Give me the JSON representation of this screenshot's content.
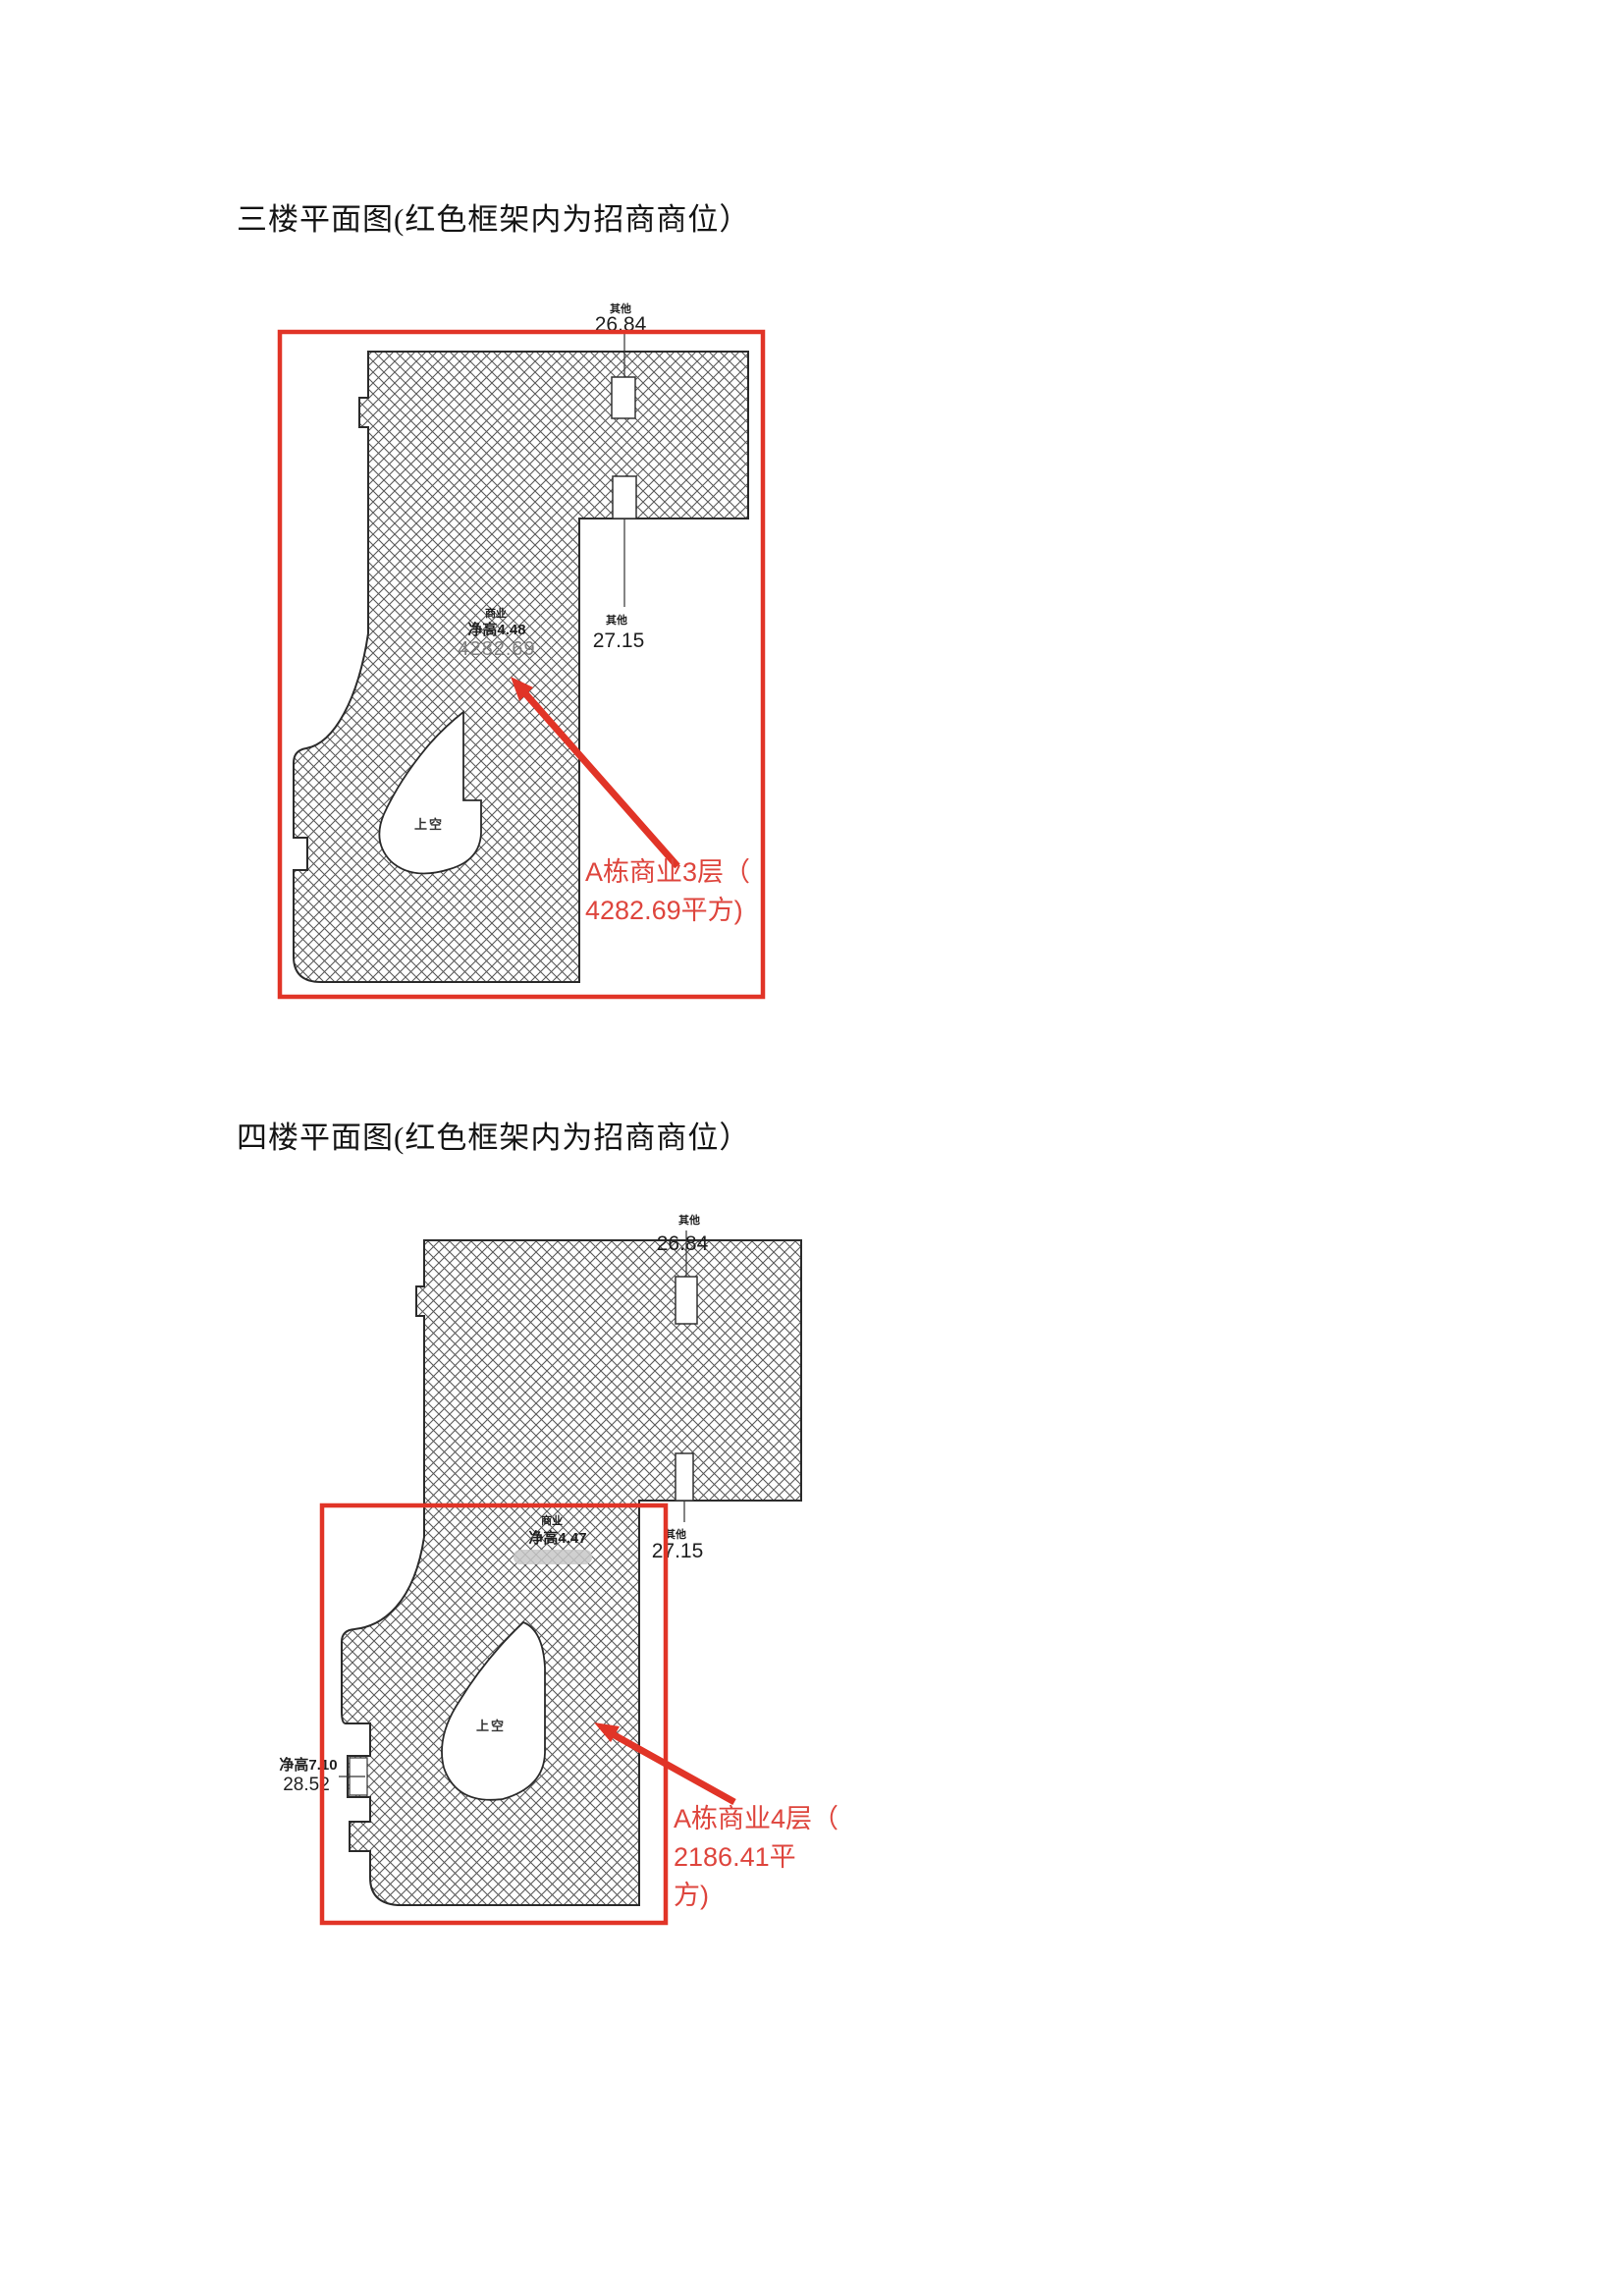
{
  "colors": {
    "frame_red": "#e13427",
    "callout_red": "#de453d",
    "outline": "#2b2b2b",
    "hatch_line": "#5a5a5a",
    "blur_pill": "#c8c8c8"
  },
  "floors": [
    {
      "title": "三楼平面图(红色框架内为招商商位）",
      "dims": {
        "top_label": "其他",
        "top_value": "26.84",
        "side_label": "其他",
        "side_value": "27.15"
      },
      "room": {
        "use": "商业",
        "clear_height": "净高4.48",
        "area": "4282.69"
      },
      "void_label": "上空",
      "callout": [
        "A栋商业3层（",
        "4282.69平方)"
      ]
    },
    {
      "title": "四楼平面图(红色框架内为招商商位）",
      "dims": {
        "top_label": "其他",
        "top_value": "26.84",
        "side_label": "其他",
        "side_value": "27.15"
      },
      "room": {
        "use": "商业",
        "clear_height": "净高4.47"
      },
      "left_dim": {
        "label": "净高7.10",
        "value": "28.52"
      },
      "void_label": "上空",
      "callout": [
        "A栋商业4层（",
        "2186.41平",
        "方)"
      ]
    }
  ]
}
